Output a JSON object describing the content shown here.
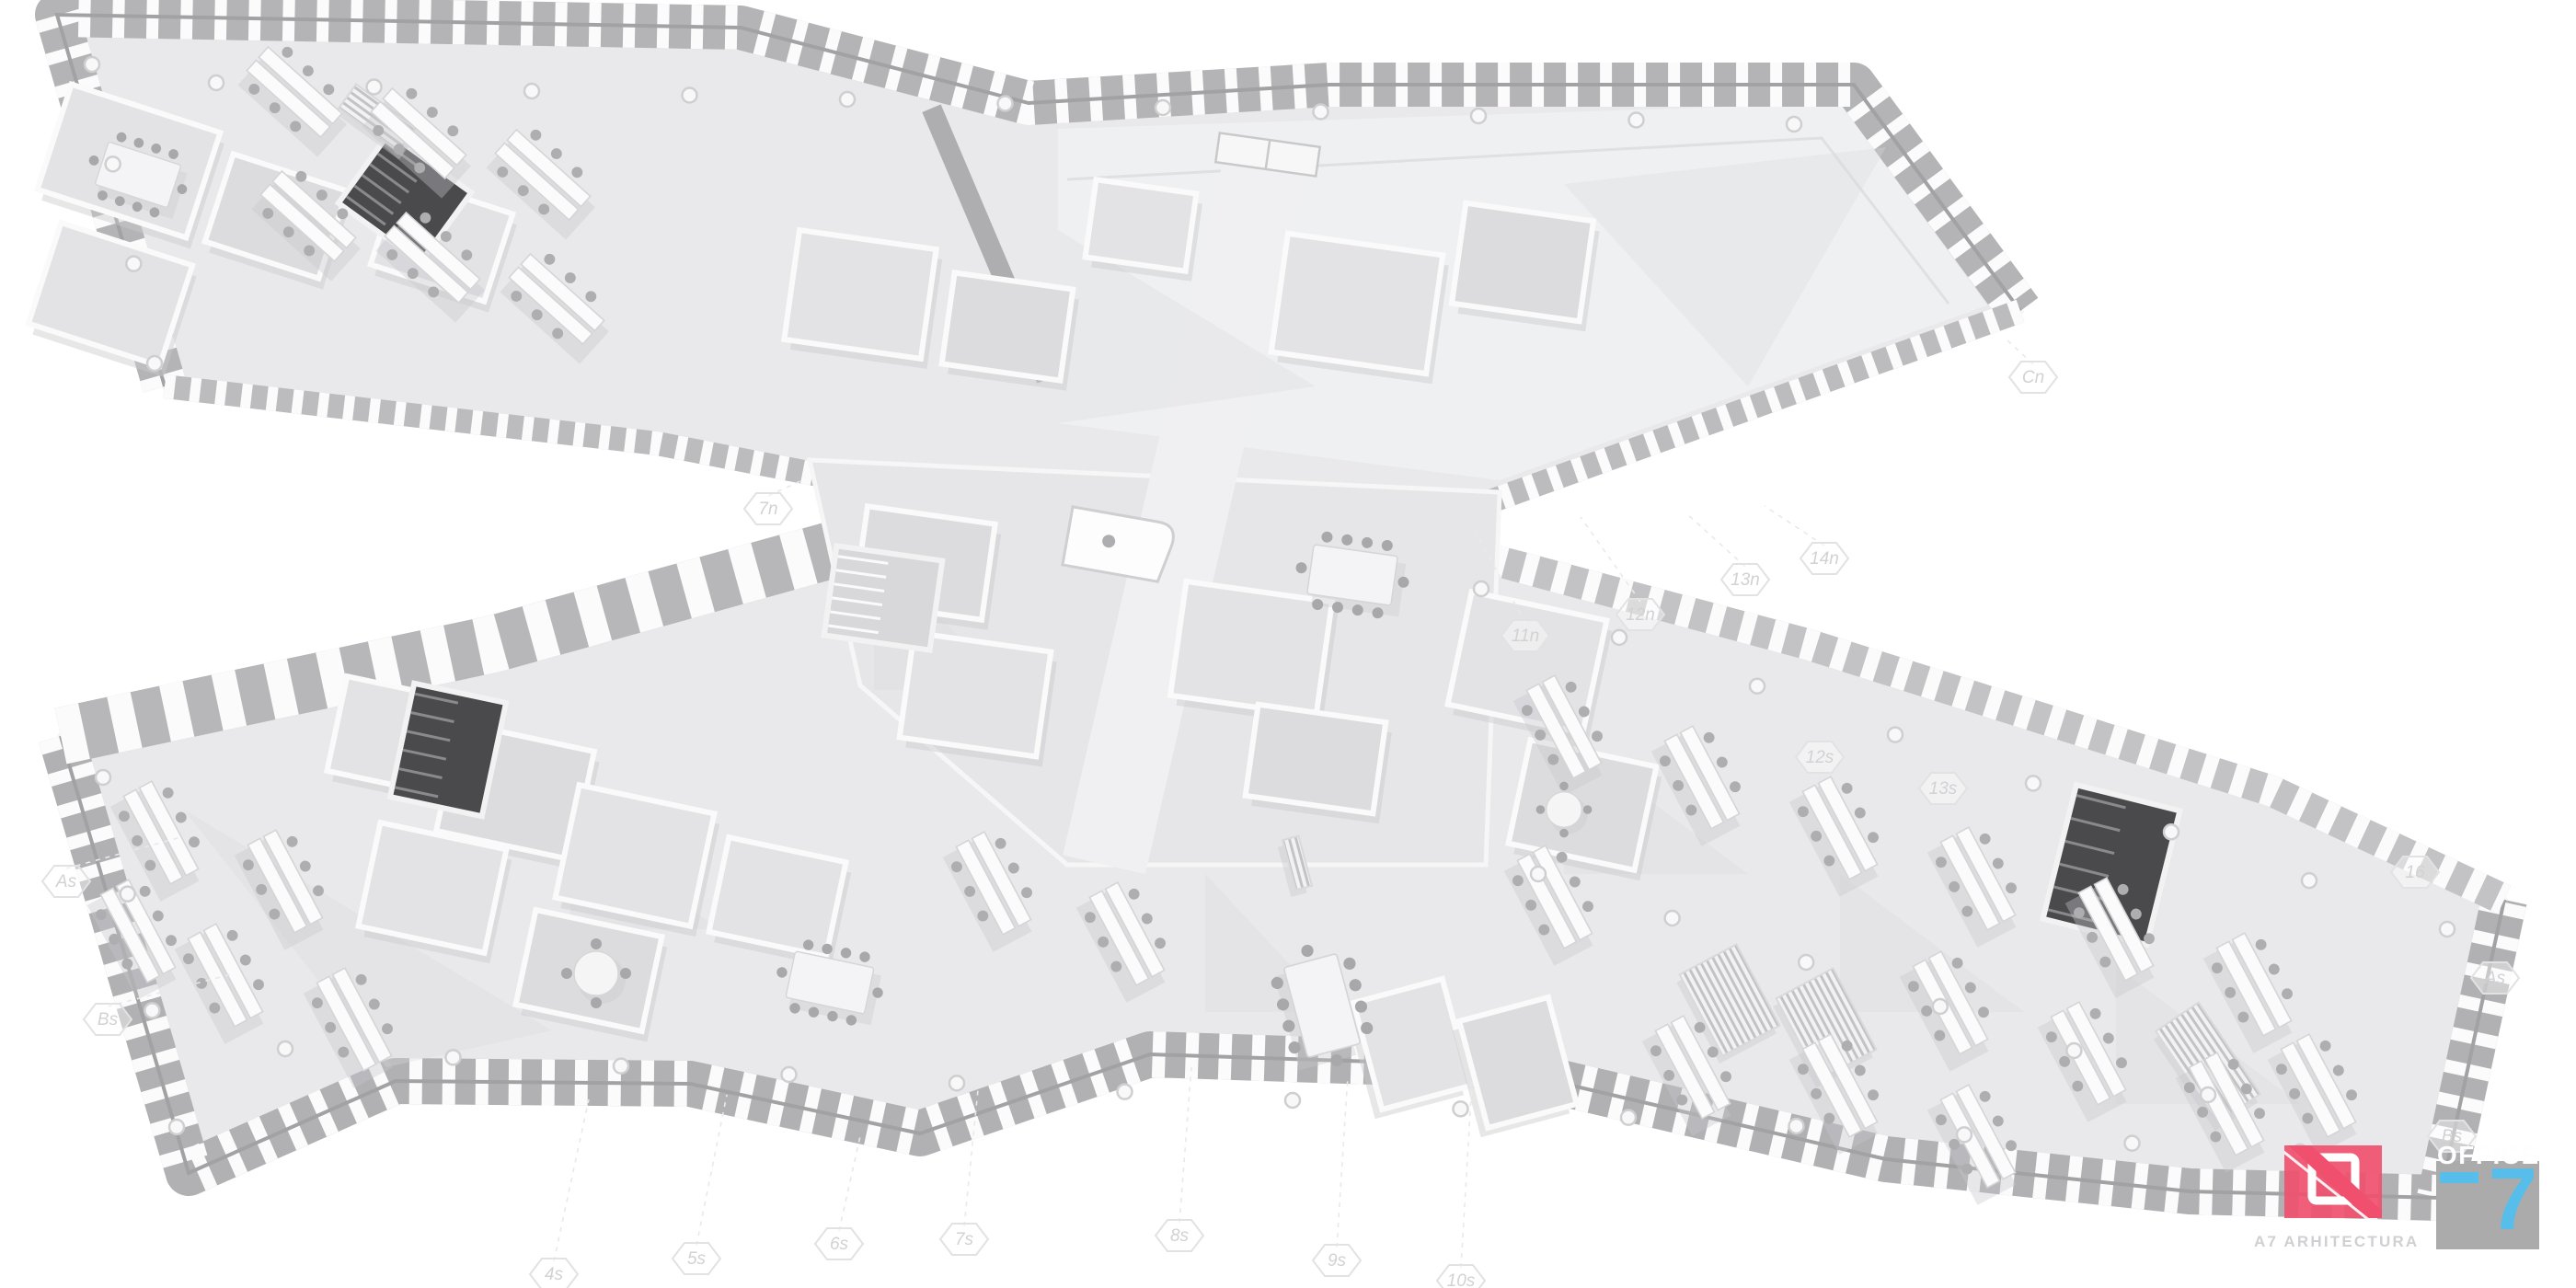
{
  "scene": {
    "type": "architectural-axonometric-floorplan-rendering",
    "description": "Monochrome 3D cutaway floor plan of an X/Z-shaped office building with two long wings joined by a central core",
    "background": "#ffffff"
  },
  "grid_markers": {
    "left": [
      "As",
      "Bs"
    ],
    "bottom": [
      "4s",
      "5s",
      "6s",
      "7s",
      "8s",
      "9s",
      "10s"
    ],
    "middle": [
      "7n",
      "11n",
      "12n",
      "13n",
      "14n"
    ],
    "facade": [
      "12s",
      "13s"
    ],
    "top_right": [
      "Cn"
    ],
    "right_end": [
      "16",
      "As",
      "Bs"
    ]
  },
  "branding": {
    "architect_logo": {
      "text": "A7 ARHITECTURA",
      "mark_color": "#f0506e",
      "text_color": "#d0d0d3"
    },
    "project_logo": {
      "title": "OFFICE",
      "numeral": "7",
      "square_color": "#ababab",
      "numeral_color": "#57bdea",
      "title_color": "#fefefe"
    }
  },
  "palette": {
    "floor": "#e9e9eb",
    "open_floor": "#eef0f2",
    "facade_band": "#b4b4b6",
    "facade_panel": "#fbfbfc",
    "roof_band": "#b7b7b9",
    "wall": "#fafafa",
    "shadow": "#d9d9dc",
    "stair_dark": "#4a4a4c",
    "chair": "#aeaeb1",
    "marker_line": "#e9e9eb"
  }
}
